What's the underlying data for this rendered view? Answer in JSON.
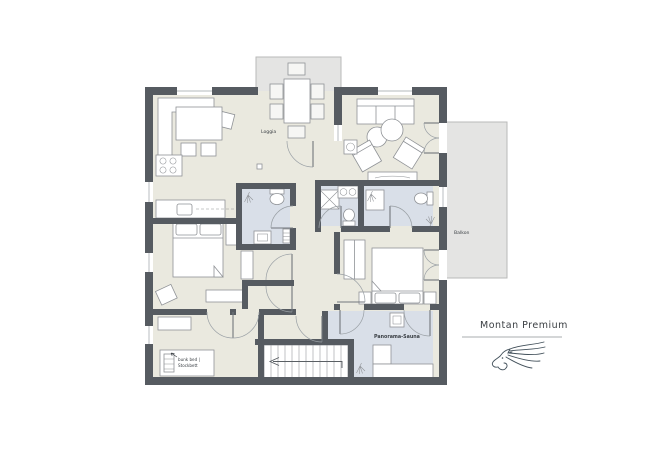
{
  "branding": {
    "name": "Montan Premium"
  },
  "plan_labels": {
    "loggia": "Loggia",
    "balkon": "Balkon",
    "sauna": "Panorama-Sauna",
    "bunk_bed_l1": "bunk bed |",
    "bunk_bed_l2": "Stockbett"
  },
  "icons": {
    "shower": "shower-head-spray-icon",
    "stairs_direction": "arrow-left-icon",
    "stove": "four-burner-cooktop-icon",
    "logo": "horse-head-line-art"
  },
  "colors": {
    "wall": "#565b61",
    "floor": "#eae9df",
    "wet_area": "#d9dfe8",
    "outdoor": "#e4e4e3",
    "outdoor_border": "#b9bab8",
    "furniture_stroke": "#8f9296",
    "door_arc": "#9aa0a5",
    "label_text": "#3c4146",
    "brand_text": "#3a3e42",
    "rule_line": "#8b9095",
    "logo": "#42505a"
  }
}
